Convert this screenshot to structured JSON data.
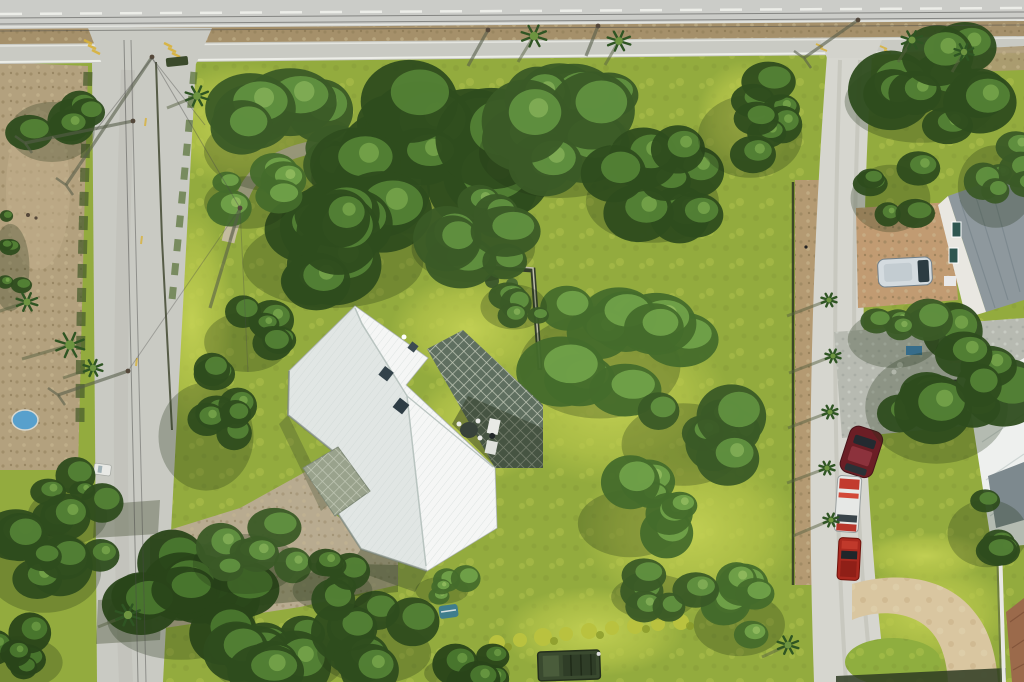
{
  "scene": {
    "type": "aerial-drone-photo",
    "description": "Top-down aerial view of a large grassy lot with an L-shaped house with a white metal roof, a gravel driveway, dense tree canopies, a paved road on the left, a highway along the top and a gravel lane with parked vehicles on the right.",
    "palette": {
      "lawn_base": "#93ab3e",
      "road_gray": "#c9cac3",
      "road_light": "#d6d6cf",
      "median_brown": "#a5906a",
      "dirt_tan": "#b3a17e",
      "driveway_tan": "#b8ab90",
      "sand_tan": "#d9c6a0",
      "roof_white": "#edf0ee",
      "lattice_dark": "#5f6f60",
      "carport_lattice": "#99a28c",
      "gray_roof": "#8e989d",
      "white_building_roof": "#eef0ee",
      "terracotta_roof": "#9b6a4b",
      "paver_gray": "#b7bab1",
      "tan_pad": "#c19b72",
      "van_silver": "#d4dbdf",
      "car_maroon": "#6b1e25",
      "pickup_red": "#a9291f",
      "utility_white": "#e6e8e6",
      "army_green": "#3a4a2f",
      "pool_blue": "#58a0cc",
      "kayak_teal": "#3f7d8c",
      "mark_yellow": "#d8b23a",
      "line_white": "#f0f1ec"
    },
    "labels": {
      "main_house": "white metal roof house",
      "patio": "lattice shade patio with table and grill",
      "carport": "lattice carport",
      "top_road": "divided highway",
      "left_road": "neighborhood street",
      "right_road": "gravel lane",
      "driveway": "gravel driveway",
      "circle_drive": "sand circular driveway"
    },
    "vehicles": [
      {
        "name": "white-van",
        "color": "#d4dbdf"
      },
      {
        "name": "maroon-car",
        "color": "#6b1e25"
      },
      {
        "name": "white-utility-truck",
        "color": "#e6e8e6"
      },
      {
        "name": "red-pickup-truck",
        "color": "#a9291f"
      },
      {
        "name": "army-green-truck",
        "color": "#3a4a2f"
      },
      {
        "name": "small-white-car",
        "color": "#e8e9e5"
      }
    ],
    "tree_tones": [
      [
        "#639441",
        "#3a5a26",
        "#86b259"
      ],
      [
        "#558436",
        "#2e4c1e",
        "#79a74c"
      ],
      [
        "#72a44a",
        "#456c2b",
        "#95bd60"
      ],
      [
        "#4b7a30",
        "#294419",
        "#6d9c43"
      ]
    ],
    "tree_clusters": [
      {
        "cx": 300,
        "cy": 135,
        "rx": 85,
        "ry": 55,
        "n": 9,
        "tone": 0,
        "layer": "back"
      },
      {
        "cx": 430,
        "cy": 155,
        "rx": 105,
        "ry": 75,
        "n": 12,
        "tone": 1,
        "layer": "back"
      },
      {
        "cx": 575,
        "cy": 135,
        "rx": 85,
        "ry": 60,
        "n": 10,
        "tone": 0,
        "layer": "back"
      },
      {
        "cx": 665,
        "cy": 185,
        "rx": 70,
        "ry": 55,
        "n": 8,
        "tone": 1,
        "layer": "back"
      },
      {
        "cx": 350,
        "cy": 245,
        "rx": 95,
        "ry": 60,
        "n": 10,
        "tone": 1,
        "layer": "back"
      },
      {
        "cx": 485,
        "cy": 235,
        "rx": 65,
        "ry": 45,
        "n": 7,
        "tone": 0,
        "layer": "back"
      },
      {
        "cx": 255,
        "cy": 192,
        "rx": 45,
        "ry": 35,
        "n": 5,
        "tone": 2,
        "layer": "back"
      },
      {
        "cx": 615,
        "cy": 345,
        "rx": 85,
        "ry": 70,
        "n": 10,
        "tone": 2,
        "layer": "back"
      },
      {
        "cx": 695,
        "cy": 428,
        "rx": 65,
        "ry": 55,
        "n": 7,
        "tone": 0,
        "layer": "back"
      },
      {
        "cx": 760,
        "cy": 120,
        "rx": 55,
        "ry": 55,
        "n": 7,
        "tone": 1,
        "layer": "back"
      },
      {
        "cx": 60,
        "cy": 120,
        "rx": 45,
        "ry": 40,
        "n": 5,
        "tone": 1,
        "layer": "back"
      },
      {
        "cx": 14,
        "cy": 250,
        "rx": 20,
        "ry": 58,
        "n": 5,
        "tone": 1,
        "layer": "back"
      },
      {
        "cx": 640,
        "cy": 510,
        "rx": 55,
        "ry": 45,
        "n": 6,
        "tone": 2,
        "layer": "back"
      },
      {
        "cx": 255,
        "cy": 330,
        "rx": 45,
        "ry": 40,
        "n": 5,
        "tone": 1,
        "layer": "back"
      },
      {
        "cx": 75,
        "cy": 505,
        "rx": 42,
        "ry": 38,
        "n": 5,
        "tone": 1,
        "layer": "back"
      },
      {
        "cx": 520,
        "cy": 298,
        "rx": 35,
        "ry": 30,
        "n": 4,
        "tone": 0,
        "layer": "back"
      },
      {
        "cx": 935,
        "cy": 85,
        "rx": 80,
        "ry": 55,
        "n": 9,
        "tone": 1,
        "layer": "front"
      },
      {
        "cx": 1003,
        "cy": 170,
        "rx": 40,
        "ry": 55,
        "n": 6,
        "tone": 0,
        "layer": "front"
      },
      {
        "cx": 898,
        "cy": 185,
        "rx": 42,
        "ry": 45,
        "n": 5,
        "tone": 1,
        "layer": "front"
      },
      {
        "cx": 215,
        "cy": 415,
        "rx": 50,
        "ry": 72,
        "n": 7,
        "tone": 1,
        "layer": "front"
      },
      {
        "cx": 55,
        "cy": 555,
        "rx": 60,
        "ry": 55,
        "n": 8,
        "tone": 1,
        "layer": "front"
      },
      {
        "cx": 195,
        "cy": 602,
        "rx": 78,
        "ry": 55,
        "n": 9,
        "tone": 3,
        "layer": "front"
      },
      {
        "cx": 290,
        "cy": 648,
        "rx": 70,
        "ry": 45,
        "n": 8,
        "tone": 1,
        "layer": "front"
      },
      {
        "cx": 28,
        "cy": 652,
        "rx": 45,
        "ry": 35,
        "n": 5,
        "tone": 3,
        "layer": "front"
      },
      {
        "cx": 255,
        "cy": 552,
        "rx": 55,
        "ry": 40,
        "n": 6,
        "tone": 0,
        "layer": "front"
      },
      {
        "cx": 385,
        "cy": 640,
        "rx": 60,
        "ry": 42,
        "n": 7,
        "tone": 1,
        "layer": "front"
      },
      {
        "cx": 475,
        "cy": 666,
        "rx": 45,
        "ry": 24,
        "n": 5,
        "tone": 3,
        "layer": "front"
      },
      {
        "cx": 950,
        "cy": 385,
        "rx": 75,
        "ry": 75,
        "n": 10,
        "tone": 1,
        "layer": "front"
      },
      {
        "cx": 902,
        "cy": 328,
        "rx": 48,
        "ry": 38,
        "n": 5,
        "tone": 0,
        "layer": "front"
      },
      {
        "cx": 995,
        "cy": 520,
        "rx": 42,
        "ry": 45,
        "n": 5,
        "tone": 1,
        "layer": "front"
      },
      {
        "cx": 748,
        "cy": 612,
        "rx": 48,
        "ry": 42,
        "n": 6,
        "tone": 2,
        "layer": "front"
      },
      {
        "cx": 662,
        "cy": 588,
        "rx": 45,
        "ry": 30,
        "n": 5,
        "tone": 0,
        "layer": "front"
      },
      {
        "cx": 340,
        "cy": 582,
        "rx": 42,
        "ry": 28,
        "n": 5,
        "tone": 1,
        "layer": "front"
      },
      {
        "cx": 447,
        "cy": 585,
        "rx": 28,
        "ry": 18,
        "n": 4,
        "tone": 2,
        "layer": "front"
      }
    ],
    "palms": [
      {
        "x": 70,
        "y": 345,
        "r": 15,
        "sh": [
          -48,
          14
        ]
      },
      {
        "x": 27,
        "y": 302,
        "r": 11,
        "sh": [
          -30,
          10
        ]
      },
      {
        "x": 197,
        "y": 96,
        "r": 12,
        "sh": [
          -30,
          12
        ]
      },
      {
        "x": 534,
        "y": 36,
        "r": 13,
        "sh": [
          -16,
          26
        ]
      },
      {
        "x": 619,
        "y": 41,
        "r": 12,
        "sh": [
          -14,
          24
        ]
      },
      {
        "x": 912,
        "y": 40,
        "r": 11,
        "sh": [
          -14,
          22
        ]
      },
      {
        "x": 964,
        "y": 52,
        "r": 10,
        "sh": [
          -12,
          20
        ]
      },
      {
        "x": 829,
        "y": 300,
        "r": 8,
        "sh": [
          -42,
          16
        ]
      },
      {
        "x": 833,
        "y": 356,
        "r": 8,
        "sh": [
          -44,
          17
        ]
      },
      {
        "x": 830,
        "y": 412,
        "r": 8,
        "sh": [
          -42,
          16
        ]
      },
      {
        "x": 827,
        "y": 468,
        "r": 8,
        "sh": [
          -40,
          15
        ]
      },
      {
        "x": 831,
        "y": 520,
        "r": 8,
        "sh": [
          -38,
          16
        ]
      },
      {
        "x": 128,
        "y": 615,
        "r": 13,
        "sh": [
          -30,
          12
        ]
      },
      {
        "x": 788,
        "y": 645,
        "r": 11,
        "sh": [
          -26,
          12
        ]
      },
      {
        "x": 93,
        "y": 368,
        "r": 10,
        "sh": [
          -30,
          10
        ]
      }
    ],
    "poles": [
      {
        "x": 152,
        "y": 57,
        "sh": [
          -86,
          128
        ],
        "cross": true
      },
      {
        "x": 133,
        "y": 121,
        "sh": [
          -108,
          22
        ],
        "cross": true
      },
      {
        "x": 128,
        "y": 371,
        "sh": [
          -70,
          24
        ],
        "cross": true
      },
      {
        "x": 240,
        "y": 208,
        "sh": [
          -30,
          100
        ],
        "cross": false
      },
      {
        "x": 488,
        "y": 30,
        "sh": [
          -20,
          36
        ],
        "cross": false
      },
      {
        "x": 598,
        "y": 26,
        "sh": [
          -12,
          30
        ],
        "cross": false
      },
      {
        "x": 858,
        "y": 20,
        "sh": [
          -54,
          38
        ],
        "cross": true
      }
    ]
  }
}
